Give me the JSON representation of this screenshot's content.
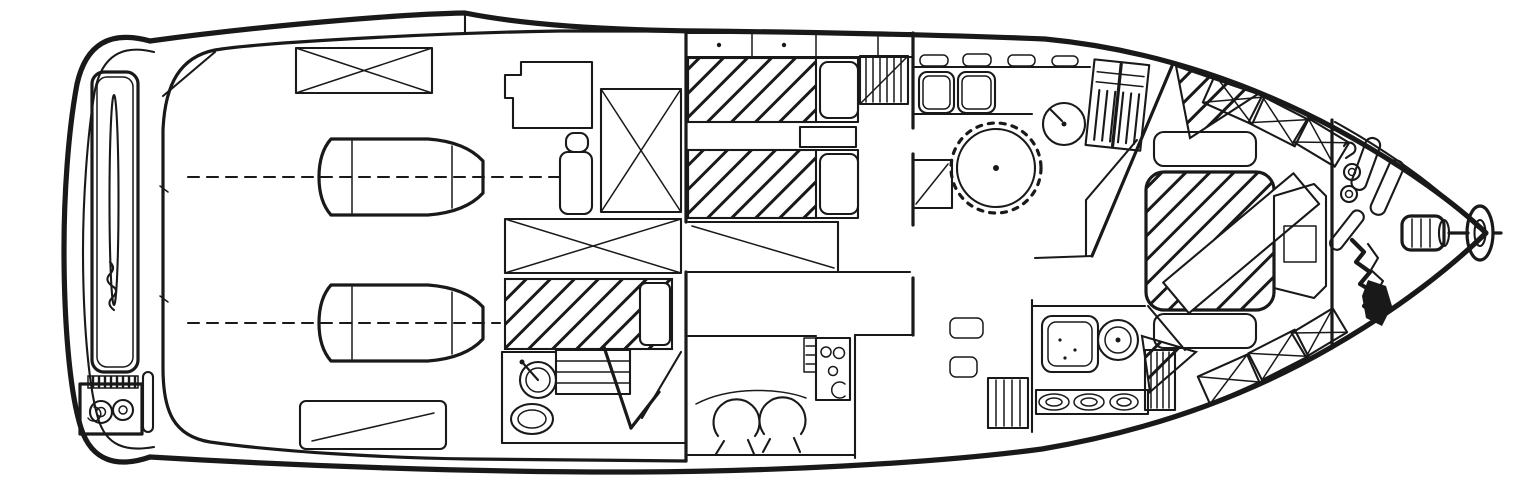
{
  "page": {
    "ink": "#191919",
    "paper": "#ffffff"
  },
  "diagram": {
    "type": "boat-floor-plan",
    "title": "Hand-drawn motor yacht interior deck plan, bow to the right",
    "orientation": {
      "bow": "right",
      "stern": "left"
    },
    "regions": [
      {
        "id": "hull",
        "label": "Hull outline with pointed bow to the right and rounded transom to the left"
      },
      {
        "id": "swim-platform",
        "label": "Stern swim platform with boat-hook stowage locker and corner deck-fitting box"
      },
      {
        "id": "aft-deck",
        "label": "Aft deck salon with crossed deck hatches and bench"
      },
      {
        "id": "engine-room",
        "label": "Engine room with twin engines, dashed propeller shaft lines, muffler and generator box"
      },
      {
        "id": "aft-cabin",
        "label": "Aft berth with hatched cushion and pillow"
      },
      {
        "id": "aft-head",
        "label": "Aft head with wash basin, toilet and V companionway steps"
      },
      {
        "id": "mid-cabin",
        "label": "Midship cabin with two hatched single berths, pillows, nightstand and ladder"
      },
      {
        "id": "dinette",
        "label": "Lower dinette with two chairs and stove with burners"
      },
      {
        "id": "galley",
        "label": "Galley with twin sinks, fiddled counter, round serrated dinette table, burner and companionway steps"
      },
      {
        "id": "fwd-head",
        "label": "Forward head with shower pan, wash basin, three-bowl vanity and steps"
      },
      {
        "id": "fwd-cabin",
        "label": "Forward stateroom with hatched island berth, headboard, side benches and crossed lockers along the hull"
      },
      {
        "id": "anchor-locker",
        "label": "Anchor locker with rings, fender capsules and chain rode"
      },
      {
        "id": "bow-pulpit",
        "label": "Bow with windlass, shaft and anchor-roller pulpit"
      }
    ]
  }
}
